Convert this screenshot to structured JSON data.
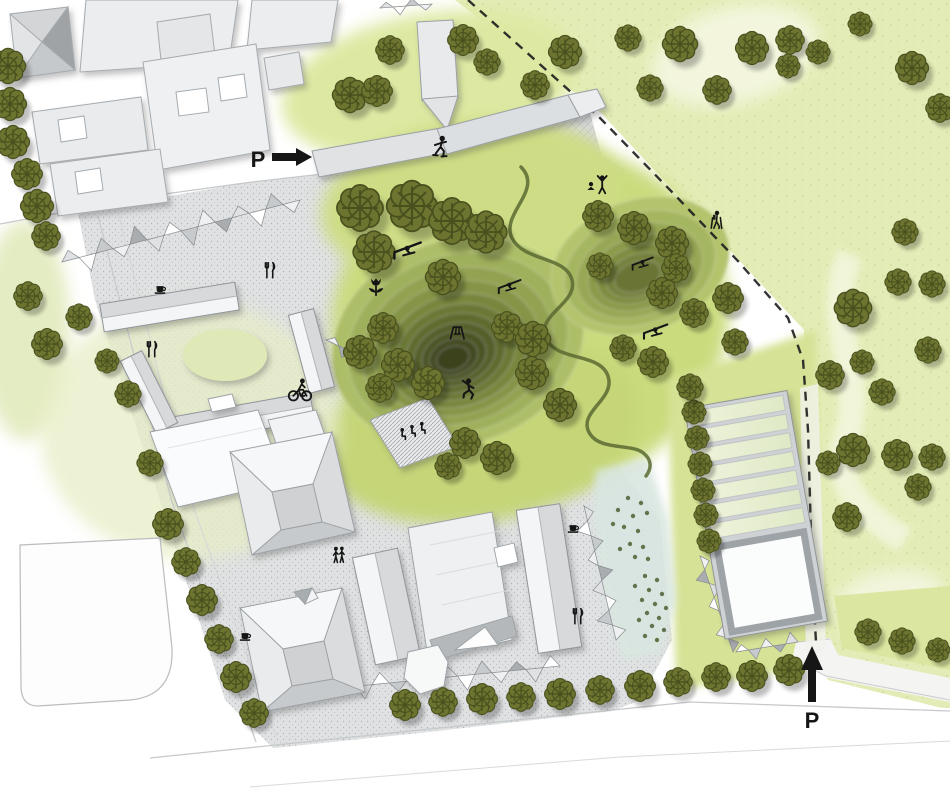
{
  "meta": {
    "type": "landscape-site-plan",
    "description": "Masterplan of a park with sledding hill, housing blocks and greenhouse"
  },
  "labels": {
    "parking_west": "P",
    "parking_south": "P"
  },
  "palette": {
    "meadow": "#e3ecb6",
    "lawn_bright": "#cadb7e",
    "hill_peak": "#3b421d",
    "tree_fill": "#6d7430",
    "tree_line": "#49501e",
    "building_light": "#f4f5f6",
    "building_mid": "#d7d9db",
    "building_dark": "#b6babd",
    "outline": "#8f959a",
    "plaza": "#dfe1e2",
    "water": "#d9e6e0",
    "path_dark": "#5b6a31",
    "icon": "#151515",
    "road_edge": "#c6c9cb"
  },
  "icons": [
    {
      "type": "skater",
      "x": 440,
      "y": 149,
      "s": 1.5
    },
    {
      "type": "sled-ramp",
      "x": 408,
      "y": 251,
      "s": 1.7
    },
    {
      "type": "sled-ramp",
      "x": 510,
      "y": 287,
      "s": 1.4
    },
    {
      "type": "sled-ramp",
      "x": 643,
      "y": 264,
      "s": 1.3
    },
    {
      "type": "sled-ramp",
      "x": 656,
      "y": 332,
      "s": 1.5
    },
    {
      "type": "flower",
      "x": 376,
      "y": 289,
      "s": 1.5
    },
    {
      "type": "swing",
      "x": 457,
      "y": 333,
      "s": 1.3
    },
    {
      "type": "climber",
      "x": 468,
      "y": 391,
      "s": 1.5
    },
    {
      "type": "yoga-pair",
      "x": 598,
      "y": 188,
      "s": 1.4
    },
    {
      "type": "hiker",
      "x": 717,
      "y": 222,
      "s": 1.3
    },
    {
      "type": "cyclist",
      "x": 300,
      "y": 391,
      "s": 1.5
    },
    {
      "type": "seated-group",
      "x": 412,
      "y": 431,
      "s": 1.4
    },
    {
      "type": "couple",
      "x": 339,
      "y": 557,
      "s": 1.3
    },
    {
      "type": "coffee-cup",
      "x": 160,
      "y": 289,
      "s": 1.2
    },
    {
      "type": "coffee-cup",
      "x": 245,
      "y": 636,
      "s": 1.2
    },
    {
      "type": "coffee-cup",
      "x": 573,
      "y": 528,
      "s": 1.2
    },
    {
      "type": "cutlery",
      "x": 270,
      "y": 271,
      "s": 1.3
    },
    {
      "type": "cutlery",
      "x": 152,
      "y": 350,
      "s": 1.3
    },
    {
      "type": "cutlery",
      "x": 578,
      "y": 617,
      "s": 1.3
    }
  ],
  "trees": [
    [
      8,
      66,
      16
    ],
    [
      10,
      104,
      15
    ],
    [
      13,
      142,
      15
    ],
    [
      27,
      174,
      14
    ],
    [
      37,
      206,
      15
    ],
    [
      46,
      236,
      13
    ],
    [
      28,
      296,
      13
    ],
    [
      79,
      317,
      12
    ],
    [
      47,
      344,
      14
    ],
    [
      107,
      361,
      11
    ],
    [
      128,
      394,
      12
    ],
    [
      150,
      463,
      12
    ],
    [
      168,
      524,
      14
    ],
    [
      186,
      562,
      13
    ],
    [
      202,
      600,
      14
    ],
    [
      219,
      639,
      13
    ],
    [
      236,
      677,
      14
    ],
    [
      254,
      713,
      13
    ],
    [
      405,
      705,
      14
    ],
    [
      443,
      702,
      13
    ],
    [
      482,
      699,
      14
    ],
    [
      521,
      697,
      13
    ],
    [
      560,
      694,
      14
    ],
    [
      600,
      690,
      13
    ],
    [
      640,
      686,
      14
    ],
    [
      678,
      682,
      13
    ],
    [
      716,
      677,
      13
    ],
    [
      752,
      676,
      14
    ],
    [
      789,
      670,
      14
    ],
    [
      694,
      412,
      11
    ],
    [
      697,
      438,
      11
    ],
    [
      700,
      464,
      11
    ],
    [
      703,
      490,
      11
    ],
    [
      706,
      515,
      11
    ],
    [
      709,
      541,
      11
    ],
    [
      360,
      208,
      21
    ],
    [
      412,
      206,
      23
    ],
    [
      452,
      221,
      21
    ],
    [
      486,
      232,
      19
    ],
    [
      374,
      252,
      19
    ],
    [
      443,
      277,
      16
    ],
    [
      383,
      328,
      14
    ],
    [
      360,
      352,
      15
    ],
    [
      398,
      365,
      15
    ],
    [
      380,
      388,
      13
    ],
    [
      428,
      383,
      15
    ],
    [
      465,
      443,
      14
    ],
    [
      448,
      466,
      12
    ],
    [
      497,
      458,
      15
    ],
    [
      507,
      327,
      14
    ],
    [
      533,
      339,
      16
    ],
    [
      532,
      373,
      15
    ],
    [
      560,
      405,
      15
    ],
    [
      598,
      216,
      14
    ],
    [
      634,
      228,
      15
    ],
    [
      672,
      243,
      15
    ],
    [
      600,
      266,
      12
    ],
    [
      676,
      268,
      13
    ],
    [
      662,
      293,
      14
    ],
    [
      694,
      313,
      13
    ],
    [
      728,
      298,
      14
    ],
    [
      623,
      348,
      12
    ],
    [
      653,
      362,
      14
    ],
    [
      735,
      342,
      12
    ],
    [
      690,
      387,
      12
    ],
    [
      390,
      50,
      13
    ],
    [
      463,
      40,
      14
    ],
    [
      487,
      62,
      12
    ],
    [
      565,
      52,
      15
    ],
    [
      535,
      85,
      13
    ],
    [
      350,
      95,
      16
    ],
    [
      377,
      91,
      14
    ],
    [
      628,
      38,
      12
    ],
    [
      650,
      88,
      12
    ],
    [
      680,
      44,
      16
    ],
    [
      717,
      90,
      13
    ],
    [
      752,
      48,
      15
    ],
    [
      790,
      40,
      13
    ],
    [
      818,
      52,
      11
    ],
    [
      860,
      24,
      11
    ],
    [
      912,
      68,
      15
    ],
    [
      940,
      108,
      13
    ],
    [
      788,
      66,
      11
    ],
    [
      853,
      308,
      17
    ],
    [
      898,
      282,
      12
    ],
    [
      932,
      284,
      12
    ],
    [
      905,
      232,
      12
    ],
    [
      830,
      375,
      13
    ],
    [
      862,
      362,
      11
    ],
    [
      882,
      392,
      12
    ],
    [
      928,
      350,
      12
    ],
    [
      853,
      450,
      15
    ],
    [
      897,
      455,
      14
    ],
    [
      932,
      457,
      12
    ],
    [
      828,
      463,
      11
    ],
    [
      918,
      487,
      12
    ],
    [
      847,
      517,
      13
    ],
    [
      868,
      632,
      12
    ],
    [
      902,
      641,
      12
    ],
    [
      938,
      650,
      11
    ]
  ],
  "water_dots": [
    [
      628,
      498
    ],
    [
      641,
      503
    ],
    [
      618,
      510
    ],
    [
      633,
      516
    ],
    [
      647,
      513
    ],
    [
      624,
      527
    ],
    [
      638,
      531
    ],
    [
      613,
      524
    ],
    [
      630,
      544
    ],
    [
      643,
      547
    ],
    [
      620,
      549
    ],
    [
      635,
      557
    ],
    [
      648,
      559
    ],
    [
      645,
      576
    ],
    [
      657,
      580
    ],
    [
      635,
      586
    ],
    [
      649,
      590
    ],
    [
      662,
      594
    ],
    [
      642,
      600
    ],
    [
      655,
      604
    ],
    [
      666,
      608
    ],
    [
      647,
      613
    ],
    [
      659,
      618
    ],
    [
      639,
      620
    ],
    [
      652,
      626
    ],
    [
      664,
      630
    ],
    [
      645,
      636
    ],
    [
      657,
      640
    ]
  ]
}
